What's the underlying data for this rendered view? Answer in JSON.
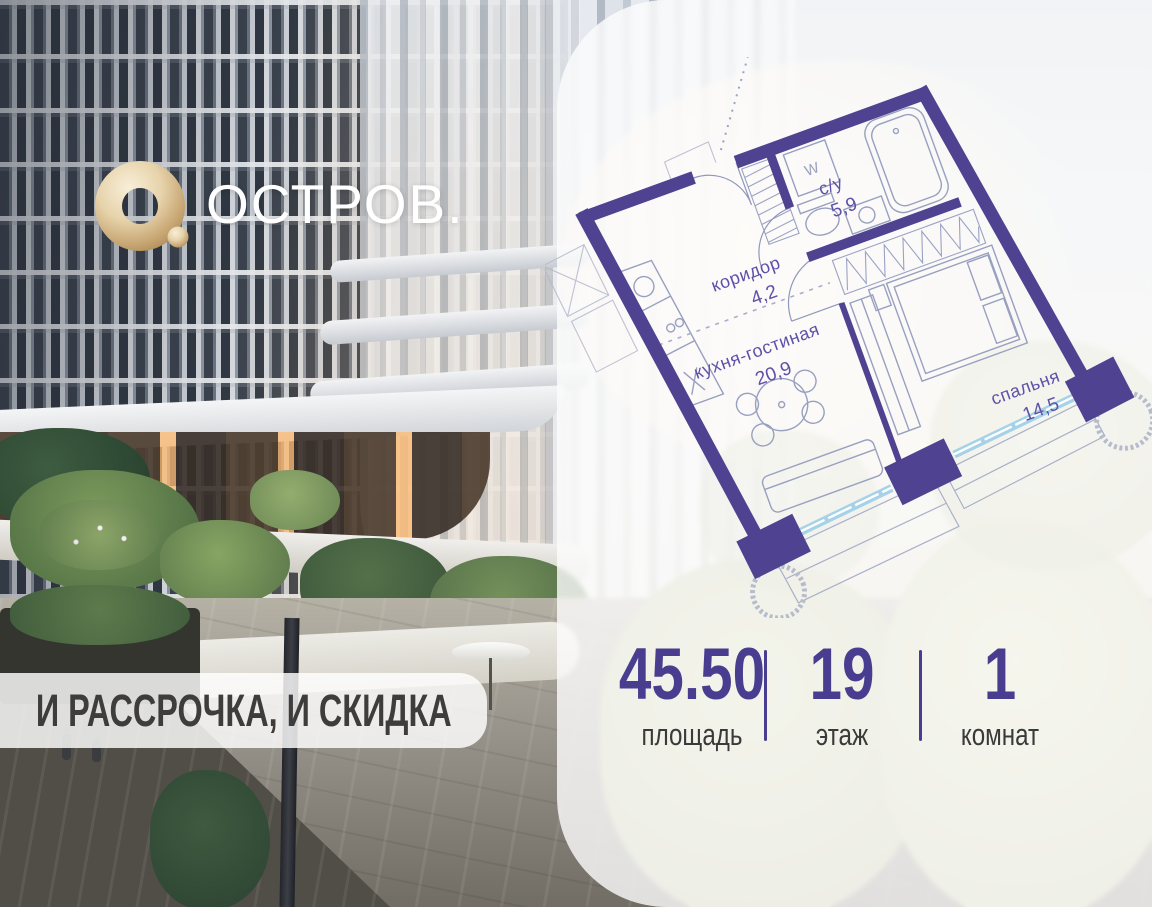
{
  "logo": {
    "brand": "ОСТРОВ."
  },
  "banner": {
    "text": "И РАССРОЧКА, И СКИДКА"
  },
  "floorplan": {
    "rooms": [
      {
        "name": "с/у",
        "area": "5,9"
      },
      {
        "name": "коридор",
        "area": "4,2"
      },
      {
        "name": "кухня-гостиная",
        "area": "20,9"
      },
      {
        "name": "спальня",
        "area": "14,5"
      }
    ],
    "washer_label": "W",
    "colors": {
      "wall": "#4e4291",
      "window": "#a5d2e8",
      "label": "#5d51a8"
    }
  },
  "stats": {
    "items": [
      {
        "value": "45.50",
        "label": "площадь"
      },
      {
        "value": "19",
        "label": "этаж"
      },
      {
        "value": "1",
        "label": "комнат"
      }
    ]
  },
  "colors": {
    "accent": "#493d90",
    "gold": "#d8bd8e"
  }
}
